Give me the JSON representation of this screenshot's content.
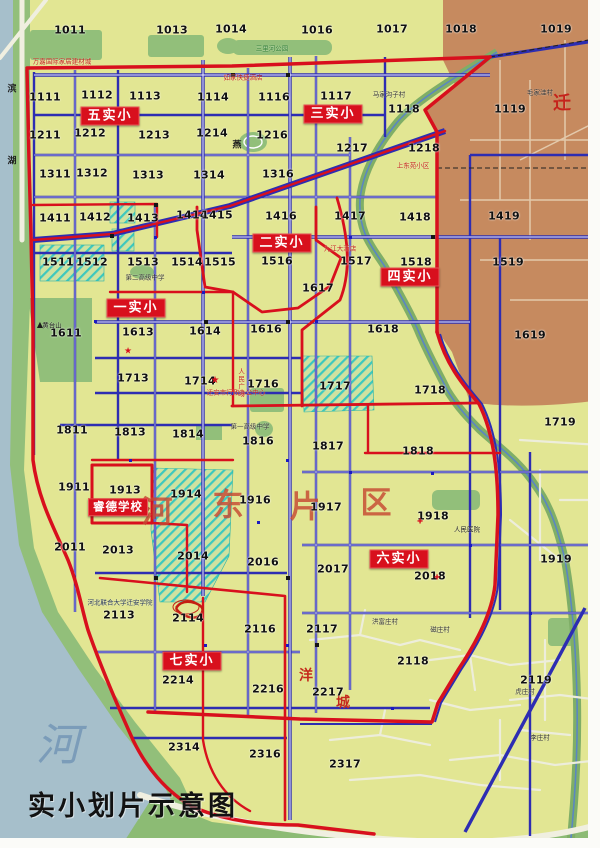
{
  "title": "实小划片示意图",
  "colors": {
    "boundary_red": "#d8101d",
    "road_blue": "#2d2db2",
    "urban_yellow": "#e2e693",
    "park_green": "#92bf7a",
    "river_blue": "#a6bfcb",
    "rural_brown": "#c68a5f",
    "hatch_cyan": "#3cc8be"
  },
  "map": {
    "zones": [
      {
        "label": "五实小",
        "x": 110,
        "y": 116
      },
      {
        "label": "三实小",
        "x": 333,
        "y": 114
      },
      {
        "label": "二实小",
        "x": 282,
        "y": 243
      },
      {
        "label": "四实小",
        "x": 410,
        "y": 277
      },
      {
        "label": "一实小",
        "x": 136,
        "y": 308
      },
      {
        "label": "六实小",
        "x": 399,
        "y": 559
      },
      {
        "label": "七实小",
        "x": 192,
        "y": 661
      },
      {
        "label": "睿德学校",
        "x": 118,
        "y": 507
      }
    ],
    "cells": [
      [
        "1011",
        70,
        30
      ],
      [
        "1013",
        172,
        30
      ],
      [
        "1014",
        231,
        29
      ],
      [
        "1016",
        317,
        30
      ],
      [
        "1017",
        392,
        29
      ],
      [
        "1018",
        461,
        29
      ],
      [
        "1019",
        556,
        29
      ],
      [
        "1111",
        45,
        97
      ],
      [
        "1112",
        97,
        95
      ],
      [
        "1113",
        145,
        96
      ],
      [
        "1114",
        213,
        97
      ],
      [
        "1116",
        274,
        97
      ],
      [
        "1117",
        336,
        96
      ],
      [
        "1118",
        404,
        109
      ],
      [
        "1119",
        510,
        109
      ],
      [
        "1211",
        45,
        135
      ],
      [
        "1212",
        90,
        133
      ],
      [
        "1213",
        154,
        135
      ],
      [
        "1214",
        212,
        133
      ],
      [
        "1216",
        272,
        135
      ],
      [
        "1217",
        352,
        148
      ],
      [
        "1218",
        424,
        148
      ],
      [
        "1311",
        55,
        174
      ],
      [
        "1312",
        92,
        173
      ],
      [
        "1313",
        148,
        175
      ],
      [
        "1314",
        209,
        175
      ],
      [
        "1316",
        278,
        174
      ],
      [
        "1411",
        55,
        218
      ],
      [
        "1412",
        95,
        217
      ],
      [
        "1413",
        143,
        218
      ],
      [
        "1414",
        192,
        215
      ],
      [
        "1415",
        217,
        215
      ],
      [
        "1416",
        281,
        216
      ],
      [
        "1417",
        350,
        216
      ],
      [
        "1418",
        415,
        217
      ],
      [
        "1419",
        504,
        216
      ],
      [
        "1511",
        58,
        262
      ],
      [
        "1512",
        92,
        262
      ],
      [
        "1513",
        143,
        262
      ],
      [
        "1514",
        187,
        262
      ],
      [
        "1515",
        220,
        262
      ],
      [
        "1516",
        277,
        261
      ],
      [
        "1517",
        356,
        261
      ],
      [
        "1518",
        416,
        262
      ],
      [
        "1519",
        508,
        262
      ],
      [
        "1611",
        66,
        333
      ],
      [
        "1613",
        138,
        332
      ],
      [
        "1614",
        205,
        331
      ],
      [
        "1616",
        266,
        329
      ],
      [
        "1617",
        318,
        288
      ],
      [
        "1618",
        383,
        329
      ],
      [
        "1619",
        530,
        335
      ],
      [
        "1713",
        133,
        378
      ],
      [
        "1714",
        200,
        381
      ],
      [
        "1716",
        263,
        384
      ],
      [
        "1717",
        335,
        386
      ],
      [
        "1718",
        430,
        390
      ],
      [
        "1719",
        560,
        422
      ],
      [
        "1811",
        72,
        430
      ],
      [
        "1813",
        130,
        432
      ],
      [
        "1814",
        188,
        434
      ],
      [
        "1816",
        258,
        441
      ],
      [
        "1817",
        328,
        446
      ],
      [
        "1818",
        418,
        451
      ],
      [
        "1911",
        74,
        487
      ],
      [
        "1913",
        125,
        490
      ],
      [
        "1914",
        186,
        494
      ],
      [
        "1916",
        255,
        500
      ],
      [
        "1917",
        326,
        507
      ],
      [
        "1918",
        433,
        516
      ],
      [
        "1919",
        556,
        559
      ],
      [
        "2011",
        70,
        547
      ],
      [
        "2013",
        118,
        550
      ],
      [
        "2014",
        193,
        556
      ],
      [
        "2016",
        263,
        562
      ],
      [
        "2017",
        333,
        569
      ],
      [
        "2018",
        430,
        576
      ],
      [
        "2113",
        119,
        615
      ],
      [
        "2114",
        188,
        618
      ],
      [
        "2116",
        260,
        629
      ],
      [
        "2117",
        322,
        629
      ],
      [
        "2118",
        413,
        661
      ],
      [
        "2119",
        536,
        680
      ],
      [
        "2214",
        178,
        680
      ],
      [
        "2216",
        268,
        689
      ],
      [
        "2217",
        328,
        692
      ],
      [
        "2314",
        184,
        747
      ],
      [
        "2316",
        265,
        754
      ],
      [
        "2317",
        345,
        764
      ]
    ],
    "big_labels": [
      {
        "t": "河",
        "x": 157,
        "y": 509,
        "cls": "district"
      },
      {
        "t": "东",
        "x": 228,
        "y": 502,
        "cls": "district"
      },
      {
        "t": "片",
        "x": 305,
        "y": 504,
        "cls": "district"
      },
      {
        "t": "区",
        "x": 376,
        "y": 500,
        "cls": "district"
      },
      {
        "t": "洋",
        "x": 306,
        "y": 675,
        "cls": "red-sm"
      },
      {
        "t": "城",
        "x": 343,
        "y": 702,
        "cls": "red-sm"
      },
      {
        "t": "迁",
        "x": 562,
        "y": 102,
        "cls": "red-md"
      },
      {
        "t": "河",
        "x": 58,
        "y": 741,
        "cls": "river"
      },
      {
        "t": "滨",
        "x": 12,
        "y": 88,
        "cls": "road"
      },
      {
        "t": "湖",
        "x": 12,
        "y": 160,
        "cls": "road"
      },
      {
        "t": "燕",
        "x": 237,
        "y": 144,
        "cls": "road"
      }
    ],
    "pois": [
      {
        "t": "万嘉国际家居建材城",
        "x": 62,
        "y": 62,
        "c": "#c42219"
      },
      {
        "t": "三里河公园",
        "x": 272,
        "y": 49,
        "c": "#2e7d32"
      },
      {
        "t": "如家快捷酒店",
        "x": 243,
        "y": 78,
        "c": "#c42219"
      },
      {
        "t": "马家沟子村",
        "x": 389,
        "y": 95,
        "c": "#333333"
      },
      {
        "t": "毛家洼村",
        "x": 540,
        "y": 93,
        "c": "#333333"
      },
      {
        "t": "上东苑小区",
        "x": 413,
        "y": 166,
        "c": "#c42219"
      },
      {
        "t": "九江大酒店",
        "x": 340,
        "y": 249,
        "c": "#c42219"
      },
      {
        "t": "第二高级中学",
        "x": 145,
        "y": 278,
        "c": "#333333"
      },
      {
        "t": "黄台山",
        "x": 52,
        "y": 326,
        "c": "#1a1a1a"
      },
      {
        "t": "人民广场",
        "x": 240,
        "y": 383,
        "c": "#c42219",
        "v": 1
      },
      {
        "t": "迁安市行政办公中心",
        "x": 236,
        "y": 393,
        "c": "#c42219"
      },
      {
        "t": "第一高级中学",
        "x": 250,
        "y": 427,
        "c": "#333333"
      },
      {
        "t": "人民医院",
        "x": 467,
        "y": 530,
        "c": "#1a1a1a"
      },
      {
        "t": "河北联合大学迁安学院",
        "x": 120,
        "y": 603,
        "c": "#223355"
      },
      {
        "t": "洪富庄村",
        "x": 385,
        "y": 622,
        "c": "#333333"
      },
      {
        "t": "磁庄村",
        "x": 440,
        "y": 630,
        "c": "#333333"
      },
      {
        "t": "虎庄村",
        "x": 525,
        "y": 692,
        "c": "#333333"
      },
      {
        "t": "李庄村",
        "x": 540,
        "y": 738,
        "c": "#333333"
      }
    ],
    "markers": [
      {
        "t": "★",
        "x": 215,
        "y": 381,
        "c": "#d8101d",
        "s": 10
      },
      {
        "t": "★",
        "x": 128,
        "y": 352,
        "c": "#d8101d",
        "s": 9
      },
      {
        "t": "✚",
        "x": 420,
        "y": 522,
        "c": "#d8101d",
        "s": 7
      },
      {
        "t": "✚",
        "x": 437,
        "y": 578,
        "c": "#d8101d",
        "s": 7
      },
      {
        "t": "▲",
        "x": 40,
        "y": 325,
        "c": "#1a1a1a",
        "s": 8
      }
    ]
  }
}
